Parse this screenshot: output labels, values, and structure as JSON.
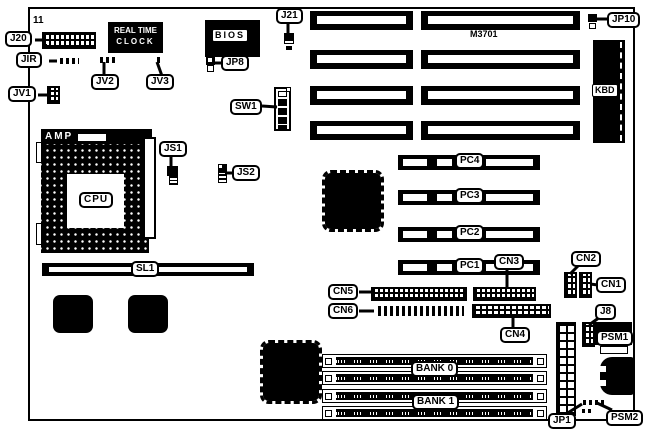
{
  "diagram": {
    "board_model": "M3701",
    "labels": {
      "j20": "J20",
      "pin11": "11",
      "jir": "JIR",
      "jv1": "JV1",
      "jv2": "JV2",
      "jv3": "JV3",
      "rtc_line1": "REAL TIME",
      "rtc_line2": "CLOCK",
      "bios": "BIOS",
      "jp8": "JP8",
      "j21": "J21",
      "jp10": "JP10",
      "kbd": "KBD",
      "sw1": "SW1",
      "amp": "AMP",
      "cpu": "CPU",
      "js1": "JS1",
      "js2": "JS2",
      "sl1": "SL1",
      "pc1": "PC1",
      "pc2": "PC2",
      "pc3": "PC3",
      "pc4": "PC4",
      "cn1": "CN1",
      "cn2": "CN2",
      "cn3": "CN3",
      "cn4": "CN4",
      "cn5": "CN5",
      "cn6": "CN6",
      "j8": "J8",
      "psm1": "PSM1",
      "psm2": "PSM2",
      "jp1": "JP1",
      "bank0": "BANK 0",
      "bank1": "BANK 1"
    },
    "colors": {
      "ink": "#000000",
      "paper": "#ffffff"
    }
  }
}
